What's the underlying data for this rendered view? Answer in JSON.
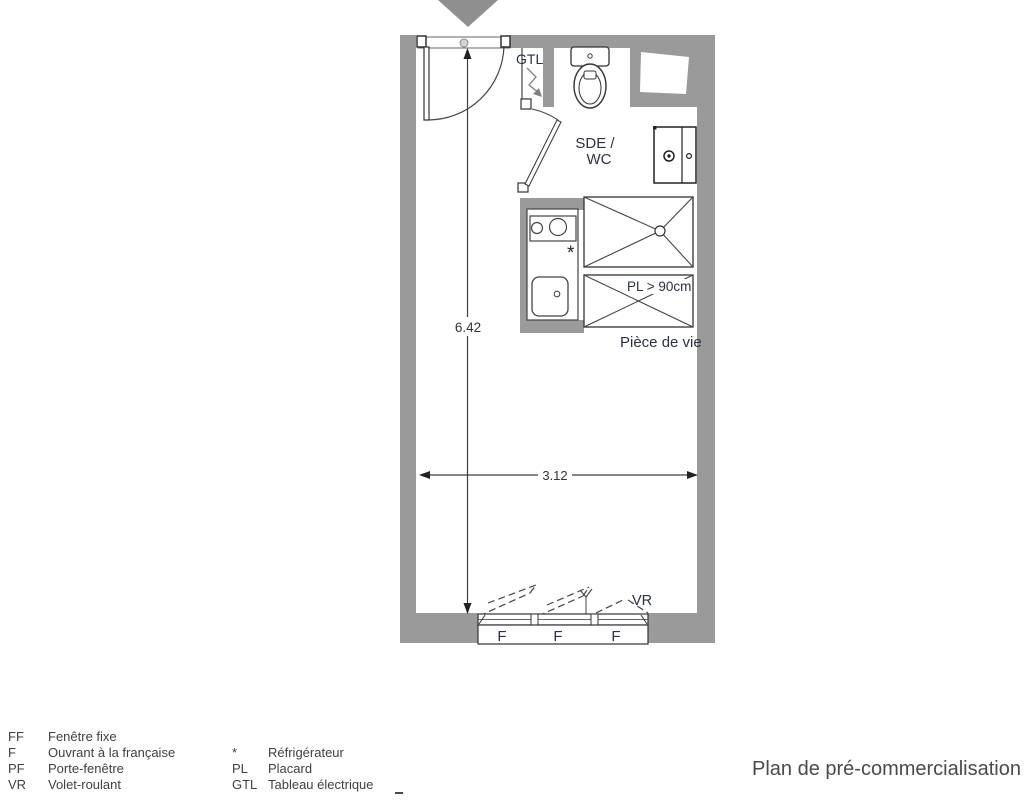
{
  "plan": {
    "labels": {
      "gtl": "GTL",
      "room_line1": "SDE /",
      "room_line2": "WC",
      "closet": "PL > 90cm",
      "living_room": "Pièce de vie",
      "shutter": "VR",
      "fridge_marker": "*",
      "window_panes": [
        "F",
        "F",
        "F"
      ]
    },
    "dimensions": {
      "height_m": "6.42",
      "width_m": "3.12"
    },
    "colors": {
      "wall": "#9a9a9a",
      "line": "#3c3c3c",
      "label": "#2a3140"
    }
  },
  "legend": {
    "column1": [
      {
        "abbr": "FF",
        "label": "Fenêtre fixe"
      },
      {
        "abbr": "F",
        "label": "Ouvrant à la française"
      },
      {
        "abbr": "PF",
        "label": "Porte-fenêtre"
      },
      {
        "abbr": "VR",
        "label": "Volet-roulant"
      }
    ],
    "column2": [
      {
        "abbr": "*",
        "label": "Réfrigérateur"
      },
      {
        "abbr": "PL",
        "label": "Placard"
      },
      {
        "abbr": "GTL",
        "label": "Tableau électrique"
      }
    ]
  },
  "footer": {
    "title": "Plan de pré-commercialisation"
  }
}
